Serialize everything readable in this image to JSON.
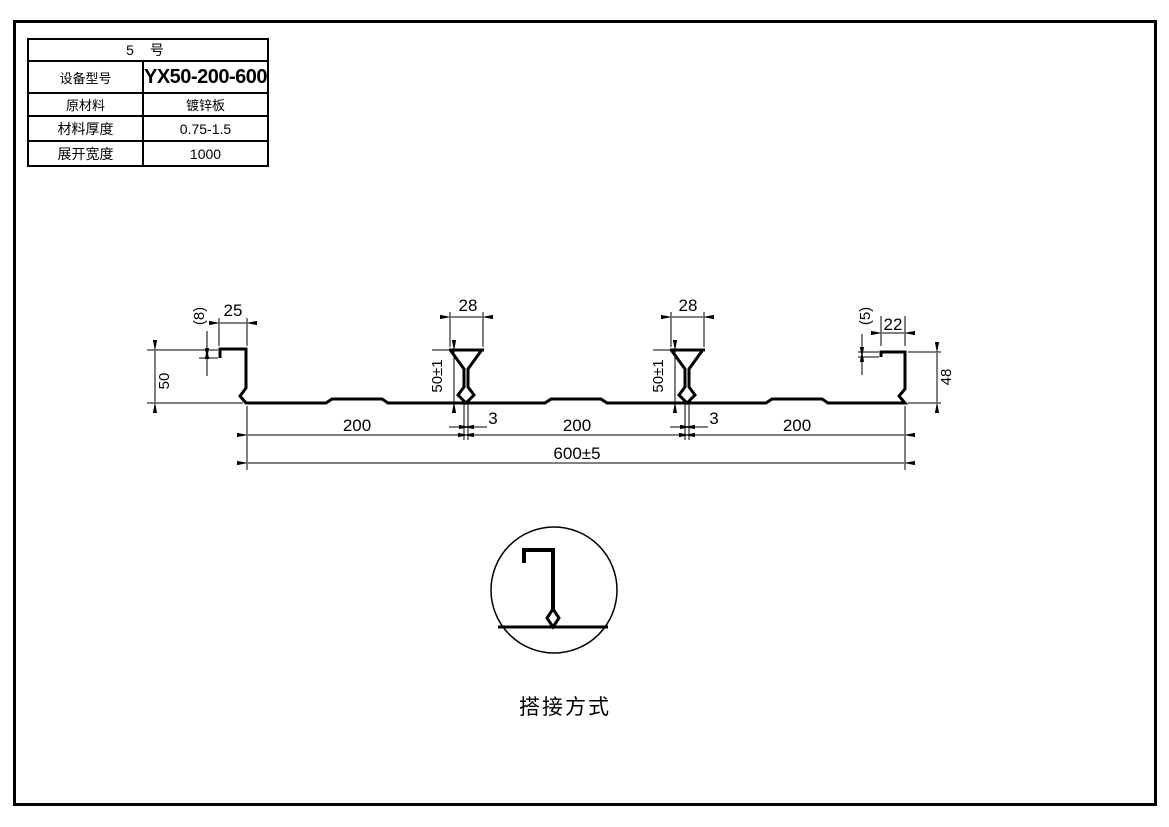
{
  "spec_table": {
    "title": "5  号",
    "rows": [
      {
        "label": "设备型号",
        "value": "YX50-200-600"
      },
      {
        "label": "原材料",
        "value": "镀锌板"
      },
      {
        "label": "材料厚度",
        "value": "0.75-1.5"
      },
      {
        "label": "展开宽度",
        "value": "1000"
      }
    ]
  },
  "drawing": {
    "dims": {
      "left_height": "50",
      "left_lip_hook": "(8)",
      "left_lip_width": "25",
      "rib_top_width": "28",
      "rib_height": "50±1",
      "rib_stem_width": "3",
      "pitch": "200",
      "overall_width": "600±5",
      "right_lip_hook": "(5)",
      "right_lip_width": "22",
      "right_height": "48"
    },
    "detail_caption": "搭接方式"
  },
  "colors": {
    "line": "#000000",
    "background": "#ffffff"
  }
}
